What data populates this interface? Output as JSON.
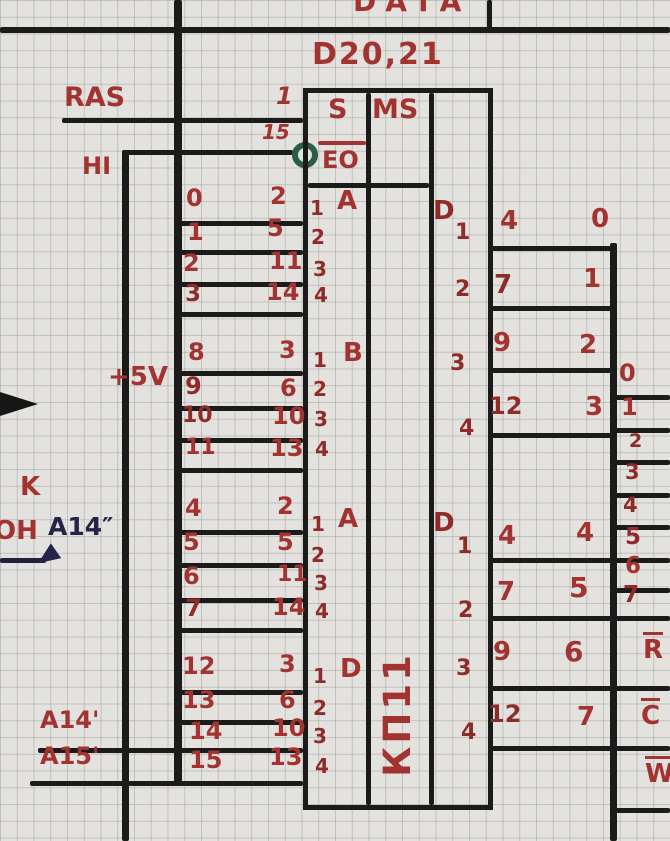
{
  "colors": {
    "ink_red": "#a23330",
    "ink_black": "#1b1b1b",
    "ink_blue": "#24244a",
    "bubble_green": "#2a5c46",
    "paper": "#e3e2de"
  },
  "header": {
    "data_bus": "DATA",
    "chip_designator": "D20,21"
  },
  "labels": {
    "ras": "RAS",
    "hi": "HI",
    "plus5v": "+5V",
    "k": "K",
    "on": "ОН",
    "a14_sec": "A14″",
    "a14_prime": "A14'",
    "a15_prime": "A15'"
  },
  "chip": {
    "type_label": "КП11",
    "select_pin_top": "1",
    "select_pin_bottom": "15",
    "header": {
      "s": "S",
      "eo": "EO",
      "ms": "MS"
    },
    "input_groups": [
      {
        "group": "A",
        "signals": [
          "0",
          "1",
          "2",
          "3"
        ],
        "pins": [
          "2",
          "5",
          "11",
          "14"
        ],
        "inputs": [
          "1",
          "2",
          "3",
          "4"
        ]
      },
      {
        "group": "B",
        "signals": [
          "8",
          "9",
          "10",
          "11"
        ],
        "pins": [
          "3",
          "6",
          "10",
          "13"
        ],
        "inputs": [
          "1",
          "2",
          "3",
          "4"
        ]
      },
      {
        "group": "A",
        "signals": [
          "4",
          "5",
          "6",
          "7"
        ],
        "pins": [
          "2",
          "5",
          "11",
          "14"
        ],
        "inputs": [
          "1",
          "2",
          "3",
          "4"
        ]
      },
      {
        "group": "D",
        "signals": [
          "12",
          "13",
          "14",
          "15"
        ],
        "pins": [
          "3",
          "6",
          "10",
          "13"
        ],
        "inputs": [
          "1",
          "2",
          "3",
          "4"
        ]
      }
    ],
    "output_groups": [
      {
        "group": "D",
        "outputs": [
          "1",
          "2",
          "3",
          "4"
        ],
        "pins": [
          "4",
          "7",
          "9",
          "12"
        ],
        "bus_labels": [
          "0",
          "1",
          "2",
          "3"
        ]
      },
      {
        "group": "D",
        "outputs": [
          "1",
          "2",
          "3",
          "4"
        ],
        "pins": [
          "4",
          "7",
          "9",
          "12"
        ],
        "bus_labels": [
          "4",
          "5",
          "6",
          "7"
        ]
      }
    ]
  },
  "connector": {
    "bus_lines": [
      "0",
      "1",
      "2",
      "3",
      "4",
      "5",
      "6",
      "7"
    ],
    "control_lines": [
      "R",
      "C",
      "W"
    ]
  }
}
